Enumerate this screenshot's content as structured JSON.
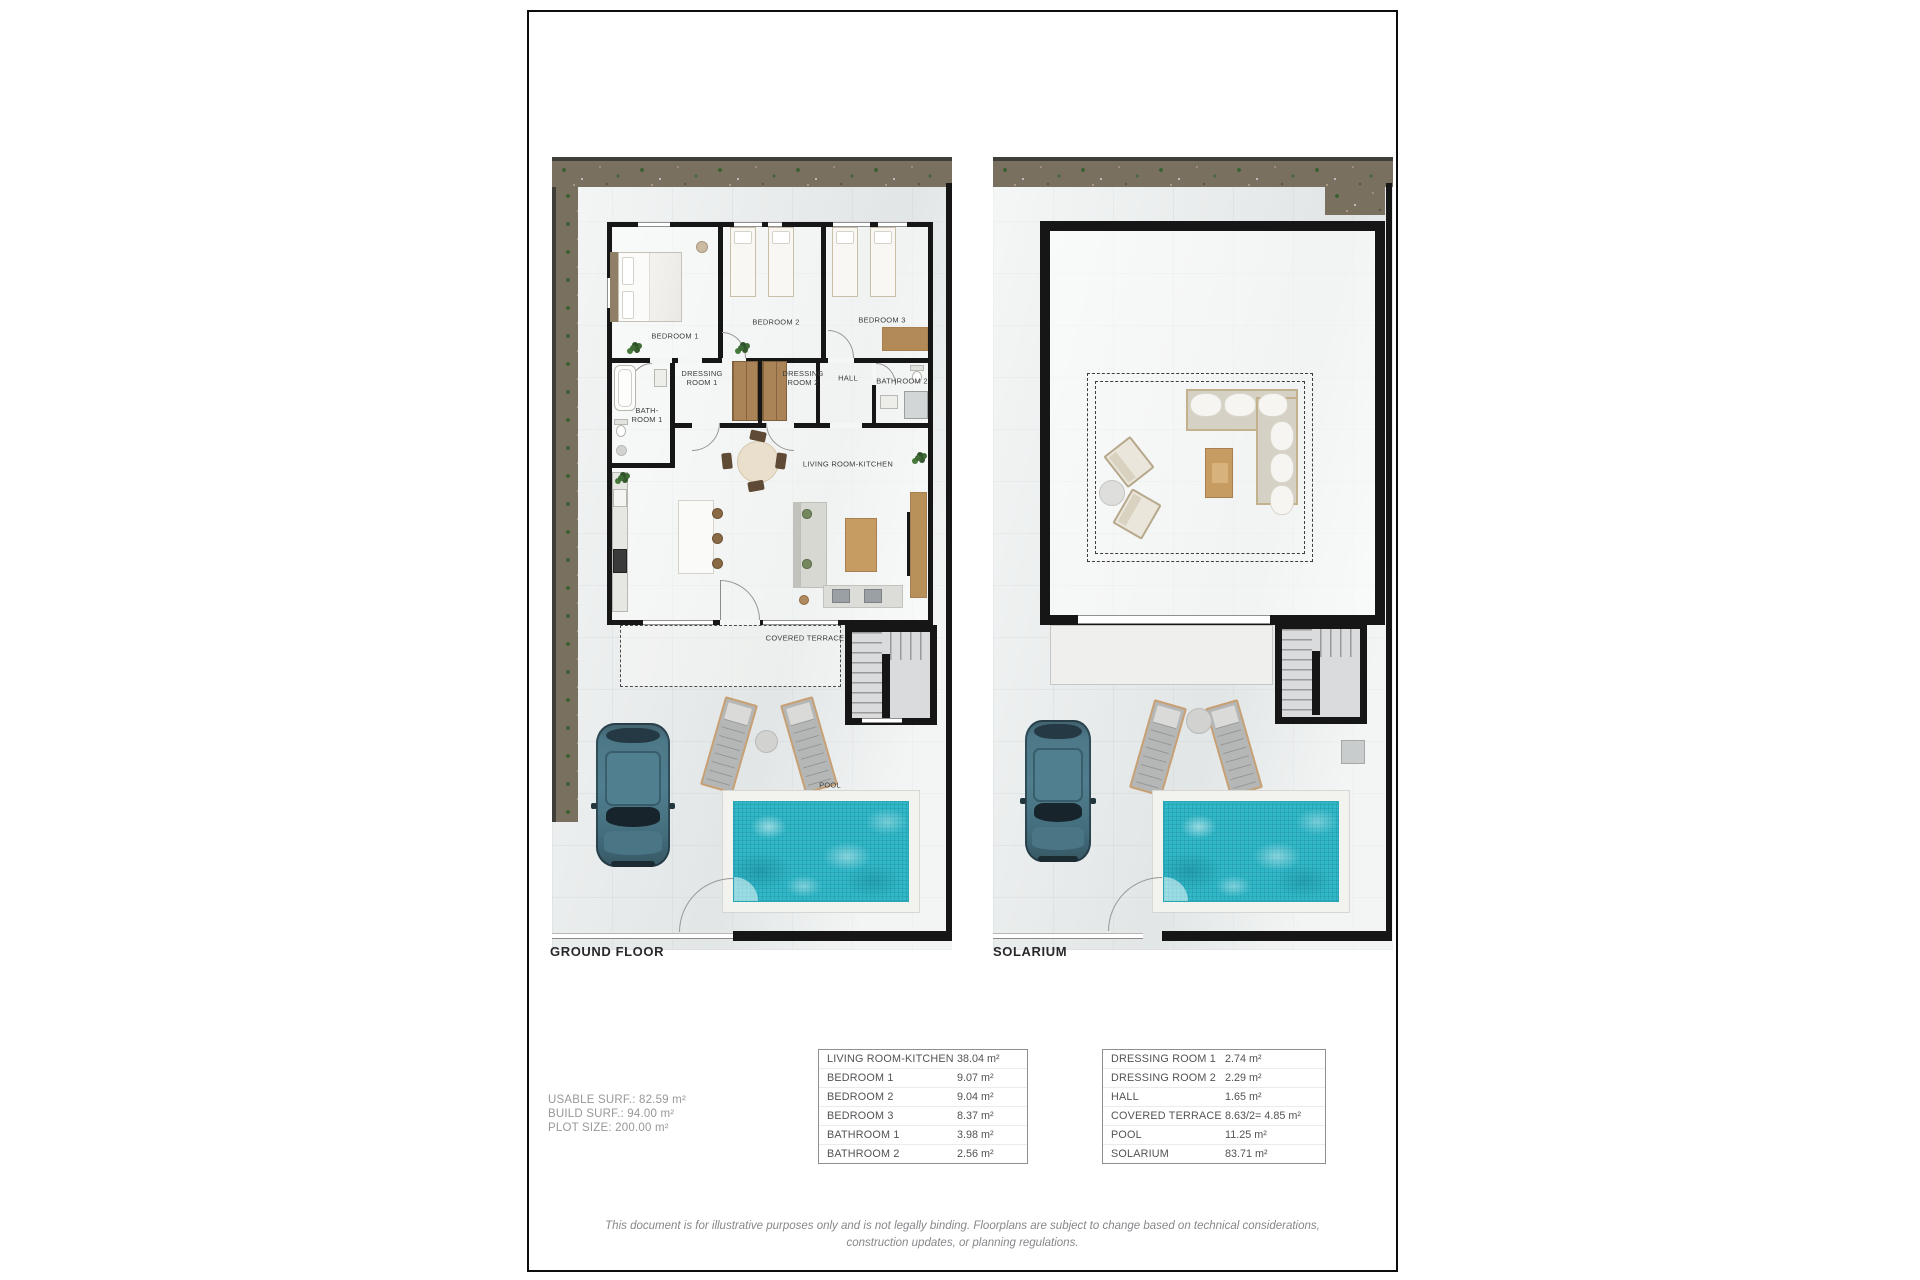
{
  "ground_floor": {
    "caption": "GROUND FLOOR",
    "labels": {
      "bedroom1": "BEDROOM 1",
      "bedroom2": "BEDROOM 2",
      "bedroom3": "BEDROOM 3",
      "bathroom1": "BATH-ROOM 1",
      "dressing1": "DRESSING ROOM 1",
      "dressing2": "DRESSING ROOM 2",
      "hall": "HALL",
      "bathroom2": "BATHROOM 2",
      "living": "LIVING ROOM-KITCHEN",
      "terrace": "COVERED TERRACE",
      "pool": "POOL"
    }
  },
  "solarium": {
    "caption": "SOLARIUM"
  },
  "summary": {
    "usable": "USABLE SURF.: 82.59 m²",
    "build": "BUILD SURF.: 94.00 m²",
    "plot": "PLOT SIZE: 200.00 m²"
  },
  "area_tables": {
    "left": {
      "rows": [
        {
          "name": "LIVING ROOM-KITCHEN",
          "value": "38.04 m²"
        },
        {
          "name": "BEDROOM 1",
          "value": "9.07 m²"
        },
        {
          "name": "BEDROOM 2",
          "value": "9.04 m²"
        },
        {
          "name": "BEDROOM 3",
          "value": "8.37 m²"
        },
        {
          "name": "BATHROOM 1",
          "value": "3.98 m²"
        },
        {
          "name": "BATHROOM 2",
          "value": "2.56 m²"
        }
      ]
    },
    "right": {
      "rows": [
        {
          "name": "DRESSING ROOM 1",
          "value": "2.74 m²"
        },
        {
          "name": "DRESSING ROOM 2",
          "value": "2.29 m²"
        },
        {
          "name": "HALL",
          "value": "1.65 m²"
        },
        {
          "name": "COVERED TERRACE",
          "value": "8.63/2= 4.85 m²"
        },
        {
          "name": "POOL",
          "value": "11.25 m²"
        },
        {
          "name": "SOLARIUM",
          "value": "83.71 m²"
        }
      ]
    }
  },
  "disclaimer": {
    "line1": "This document is for illustrative purposes only and is not legally binding. Floorplans are subject to change based on technical considerations,",
    "line2": "construction updates, or planning regulations."
  },
  "colors": {
    "pool_water": "#31b8c8",
    "wall": "#161616",
    "accent_wood": "#c79c63",
    "car": "#4b7587"
  }
}
